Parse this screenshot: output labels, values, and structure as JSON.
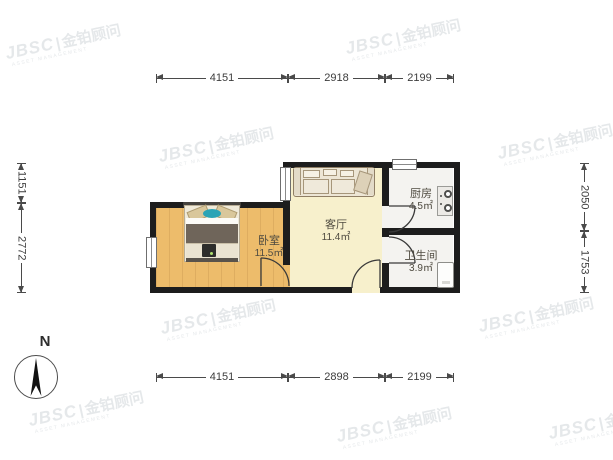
{
  "watermark": {
    "brand": "JBSC",
    "separator": "|",
    "name": "金铂顾问",
    "subtext": "ASSET MANAGEMENT",
    "positions": [
      [
        5,
        33
      ],
      [
        345,
        28
      ],
      [
        158,
        136
      ],
      [
        497,
        133
      ],
      [
        318,
        234
      ],
      [
        160,
        308
      ],
      [
        478,
        306
      ],
      [
        28,
        400
      ],
      [
        336,
        416
      ],
      [
        548,
        413
      ]
    ]
  },
  "compass": {
    "label": "N"
  },
  "rooms": [
    {
      "id": "bedroom",
      "name": "卧室",
      "area": "11.5㎡"
    },
    {
      "id": "living",
      "name": "客厅",
      "area": "11.4㎡"
    },
    {
      "id": "kitchen",
      "name": "厨房",
      "area": "4.5㎡"
    },
    {
      "id": "bathroom",
      "name": "卫生间",
      "area": "3.9㎡"
    }
  ],
  "dimensions": {
    "top": [
      "4151",
      "2918",
      "2199"
    ],
    "bottom": [
      "4151",
      "2898",
      "2199"
    ],
    "left": [
      "1151",
      "2772"
    ],
    "right": [
      "2050",
      "1753"
    ]
  },
  "colors": {
    "wall": "#1d1d1d",
    "wood_floor": "#edbc6b",
    "living_floor": "#f7f0cc",
    "tile_floor": "#f4f3f0",
    "dimension": "#4a4a4a",
    "bed_accent_teal": "#2ba4b6"
  }
}
